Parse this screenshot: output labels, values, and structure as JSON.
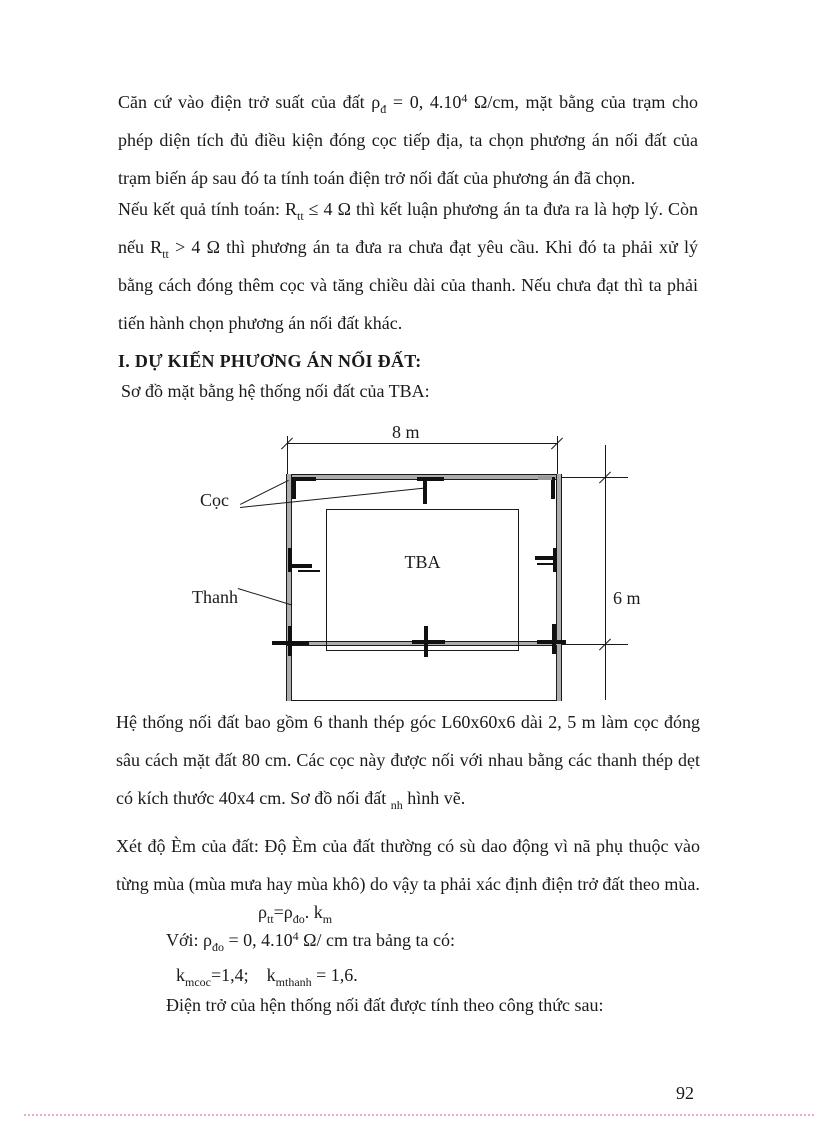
{
  "p1": {
    "s1": "Căn cứ vào điện trở suất của đất ρ",
    "sub1": "đ",
    "s2": " = 0, 4.10",
    "sup1": "4",
    "s3": " Ω/cm, mặt bằng của trạm cho phép diện tích đủ điều kiện đóng cọc tiếp địa, ta chọn phương án nối đất của trạm biến áp sau đó ta tính toán điện trở nối đất của phương án đã chọn."
  },
  "p2": {
    "s1": "Nếu kết quả tính toán: R",
    "sub1": "tt",
    "s2": " ≤ 4 Ω thì kết luận phương án ta đưa ra là hợp lý. Còn nếu R",
    "sub2": "tt",
    "s3": " > 4 Ω thì phương án ta đưa ra chưa đạt yêu cầu. Khi đó ta phải xử lý bằng cách đóng thêm cọc và tăng chiều dài của thanh. Nếu chưa đạt thì ta phải tiến hành chọn phương án nối đất khác."
  },
  "heading": "I. DỰ KIẾN PHƯƠNG ÁN NỐI ĐẤT:",
  "subtitle": "Sơ đồ mặt bằng hệ thống nối đất của TBA:",
  "diagram": {
    "width_label": "8 m",
    "height_label": "6 m",
    "electrode_label": "Cọc",
    "bar_label": "Thanh",
    "station_label": "TBA"
  },
  "p3": {
    "s1": "Hệ thống nối đất bao gồm 6 thanh thép góc L60x60x6 dài 2, 5 m làm cọc đóng sâu cách mặt đất 80 cm. Các cọc này được nối với nhau bằng các thanh thép dẹt có kích thước 40x4 cm. Sơ đồ nối đất ",
    "sub1": "nh",
    "s2": "  hình vẽ."
  },
  "p4": "Xét độ Èm của đất: Độ Èm của đất thường có sù dao động vì nã phụ thuộc vào từng mùa (mùa mưa hay mùa khô) do vậy ta phải xác định điện trở đất theo mùa.",
  "f1": {
    "s1": "ρ",
    "sub1": "tt",
    "s2": "=ρ",
    "sub2": "đo",
    "s3": ". k",
    "sub3": "m"
  },
  "f2": {
    "s1": "Với: ρ",
    "sub1": "đo",
    "s2": " = 0, 4.10",
    "sup1": "4",
    "s3": " Ω/ cm tra bảng ta có:"
  },
  "f3": {
    "s1": "k",
    "sub1": "mcoc",
    "s2": "=1,4;    k",
    "sub2": "mthanh",
    "s3": " = 1,6."
  },
  "f4": "Điện trở của hện thống nối đất được tính theo công thức sau:",
  "page_number": "92",
  "colors": {
    "ink": "#1a1a1a",
    "bar_fill": "#adadad",
    "page_break_dots": "#f2a7d3"
  }
}
